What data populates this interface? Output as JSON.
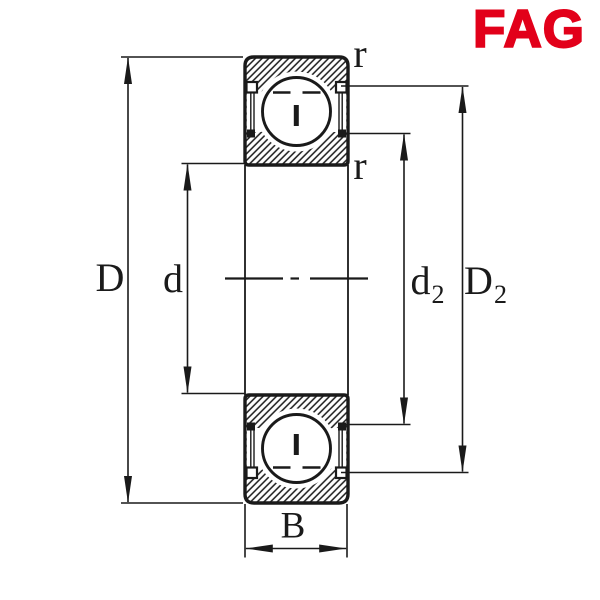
{
  "brand": {
    "name": "FAG",
    "color": "#e2001a"
  },
  "figure": {
    "description": "Deep groove ball bearing cross-section technical drawing with shields",
    "line_color": "#1a1a1a",
    "background": "#ffffff",
    "dimensions": {
      "outer_diameter": {
        "label": "D"
      },
      "bore_diameter": {
        "label": "d"
      },
      "inner_shoulder_diameter": {
        "label": "d",
        "sub": "2"
      },
      "outer_shoulder_diameter": {
        "label": "D",
        "sub": "2"
      },
      "width": {
        "label": "B"
      },
      "chamfer_radius_top": {
        "label": "r"
      },
      "chamfer_radius_bottom": {
        "label": "r"
      }
    }
  }
}
